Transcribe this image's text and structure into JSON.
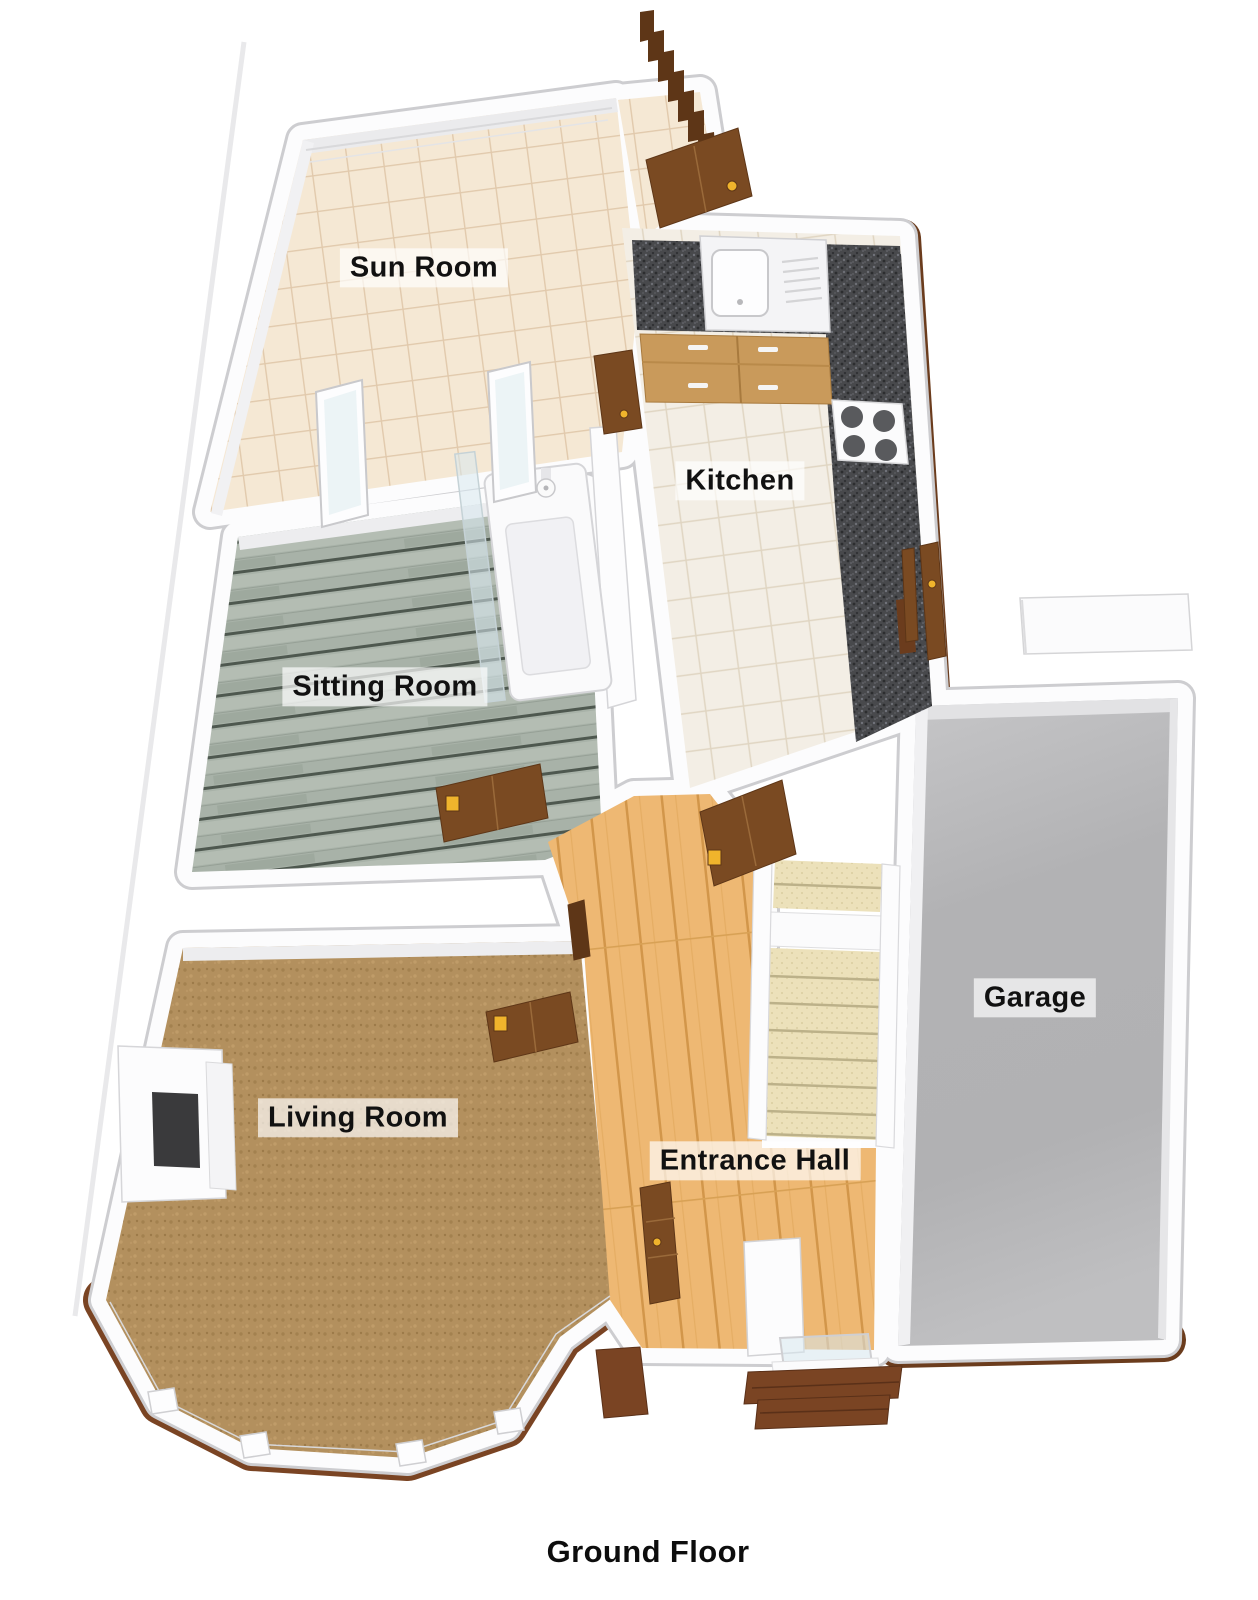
{
  "title": "Ground Floor",
  "rooms": [
    {
      "id": "sun-room",
      "label": "Sun Room",
      "floor_material": "beige-tile"
    },
    {
      "id": "kitchen",
      "label": "Kitchen",
      "floor_material": "cream-tile"
    },
    {
      "id": "sitting-room",
      "label": "Sitting Room",
      "floor_material": "grey-washed-wood-planks"
    },
    {
      "id": "living-room",
      "label": "Living Room",
      "floor_material": "brown-carpet"
    },
    {
      "id": "entrance-hall",
      "label": "Entrance Hall",
      "floor_material": "light-oak-wood"
    },
    {
      "id": "garage",
      "label": "Garage",
      "floor_material": "grey-concrete"
    }
  ],
  "fixtures": {
    "kitchen": [
      "sink-with-drainer",
      "granite-worktop",
      "base-cabinets",
      "hob-4-ring"
    ],
    "bath_nook": [
      "bath-with-tap",
      "glass-screen"
    ],
    "entrance_hall": [
      "staircase",
      "front-door",
      "brick-entry-steps"
    ],
    "living_room": [
      "fireplace",
      "bay-window"
    ],
    "sun_room": [
      "french-doors"
    ],
    "doors_count": 8
  },
  "palette": {
    "wall_white": "#fcfcfd",
    "wall_hairline": "#cdcdd0",
    "tile_sun": "#f5e8d4",
    "tile_kitchen": "#f3eee5",
    "plank_base": "#a8b2a8",
    "carpet_brown": "#b3905e",
    "hall_wood": "#eeb873",
    "stair_carpet": "#ece1ba",
    "granite_base": "#48494c",
    "cabinet_wood": "#c99a5b",
    "door_wood": "#7a4a22",
    "door_wood_dark": "#5e3617",
    "handle_gold": "#f0b42c",
    "brick": "#7a4423",
    "garage_floor": "#b5b5b7",
    "glass": "rgba(215,232,238,0.55)",
    "label_text": "#111111"
  }
}
